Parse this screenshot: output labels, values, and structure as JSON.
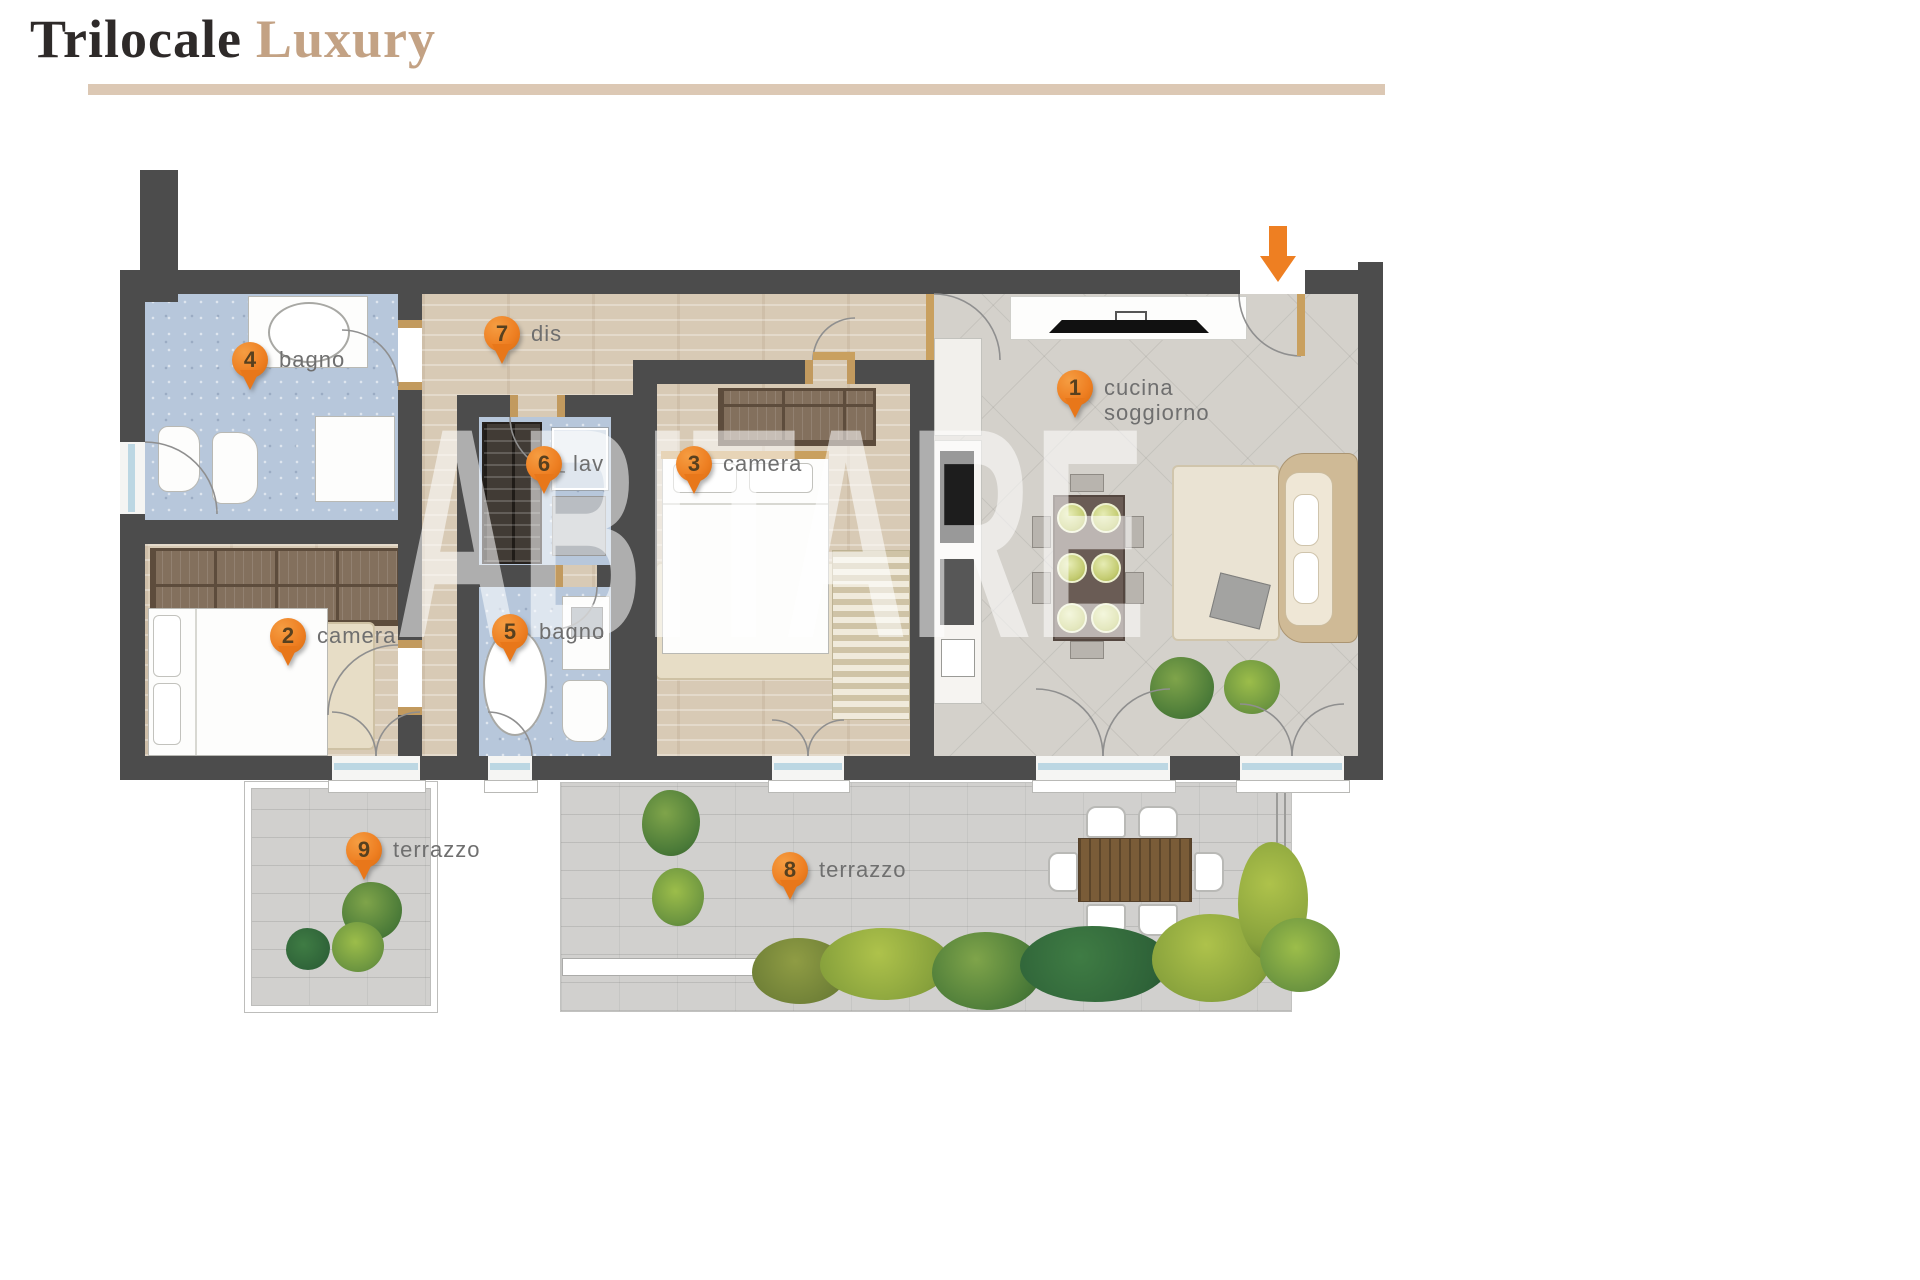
{
  "header": {
    "title_primary": "Trilocale",
    "title_secondary": "Luxury"
  },
  "plan": {
    "watermark": "ABITARE",
    "markers": [
      {
        "number": "1",
        "label": "cucina",
        "label2": "soggiorno"
      },
      {
        "number": "2",
        "label": "camera"
      },
      {
        "number": "3",
        "label": "camera"
      },
      {
        "number": "4",
        "label": "bagno"
      },
      {
        "number": "5",
        "label": "bagno"
      },
      {
        "number": "6",
        "label": "lav"
      },
      {
        "number": "7",
        "label": "dis"
      },
      {
        "number": "8",
        "label": "terrazzo"
      },
      {
        "number": "9",
        "label": "terrazzo"
      }
    ]
  },
  "colors": {
    "wall": "#4c4c4c",
    "marker_orange": "#ee7f22",
    "entrance_arrow": "#ee7f22",
    "title_dark": "#2e2a29",
    "title_tan": "#c3a284",
    "underline_tan": "#dcc8b4",
    "bath_floor": "#b7c7db",
    "wood_floor": "#d8cab5",
    "living_floor": "#d4d1cb",
    "terrace_floor": "#d1d0ce",
    "label_gray": "#6f6f6f",
    "door_accent_tan": "#c9a05f",
    "hedge_greens": [
      "#7fa44a",
      "#9cbd4a",
      "#3f7c44",
      "#aec24b",
      "#8f9c44"
    ]
  }
}
